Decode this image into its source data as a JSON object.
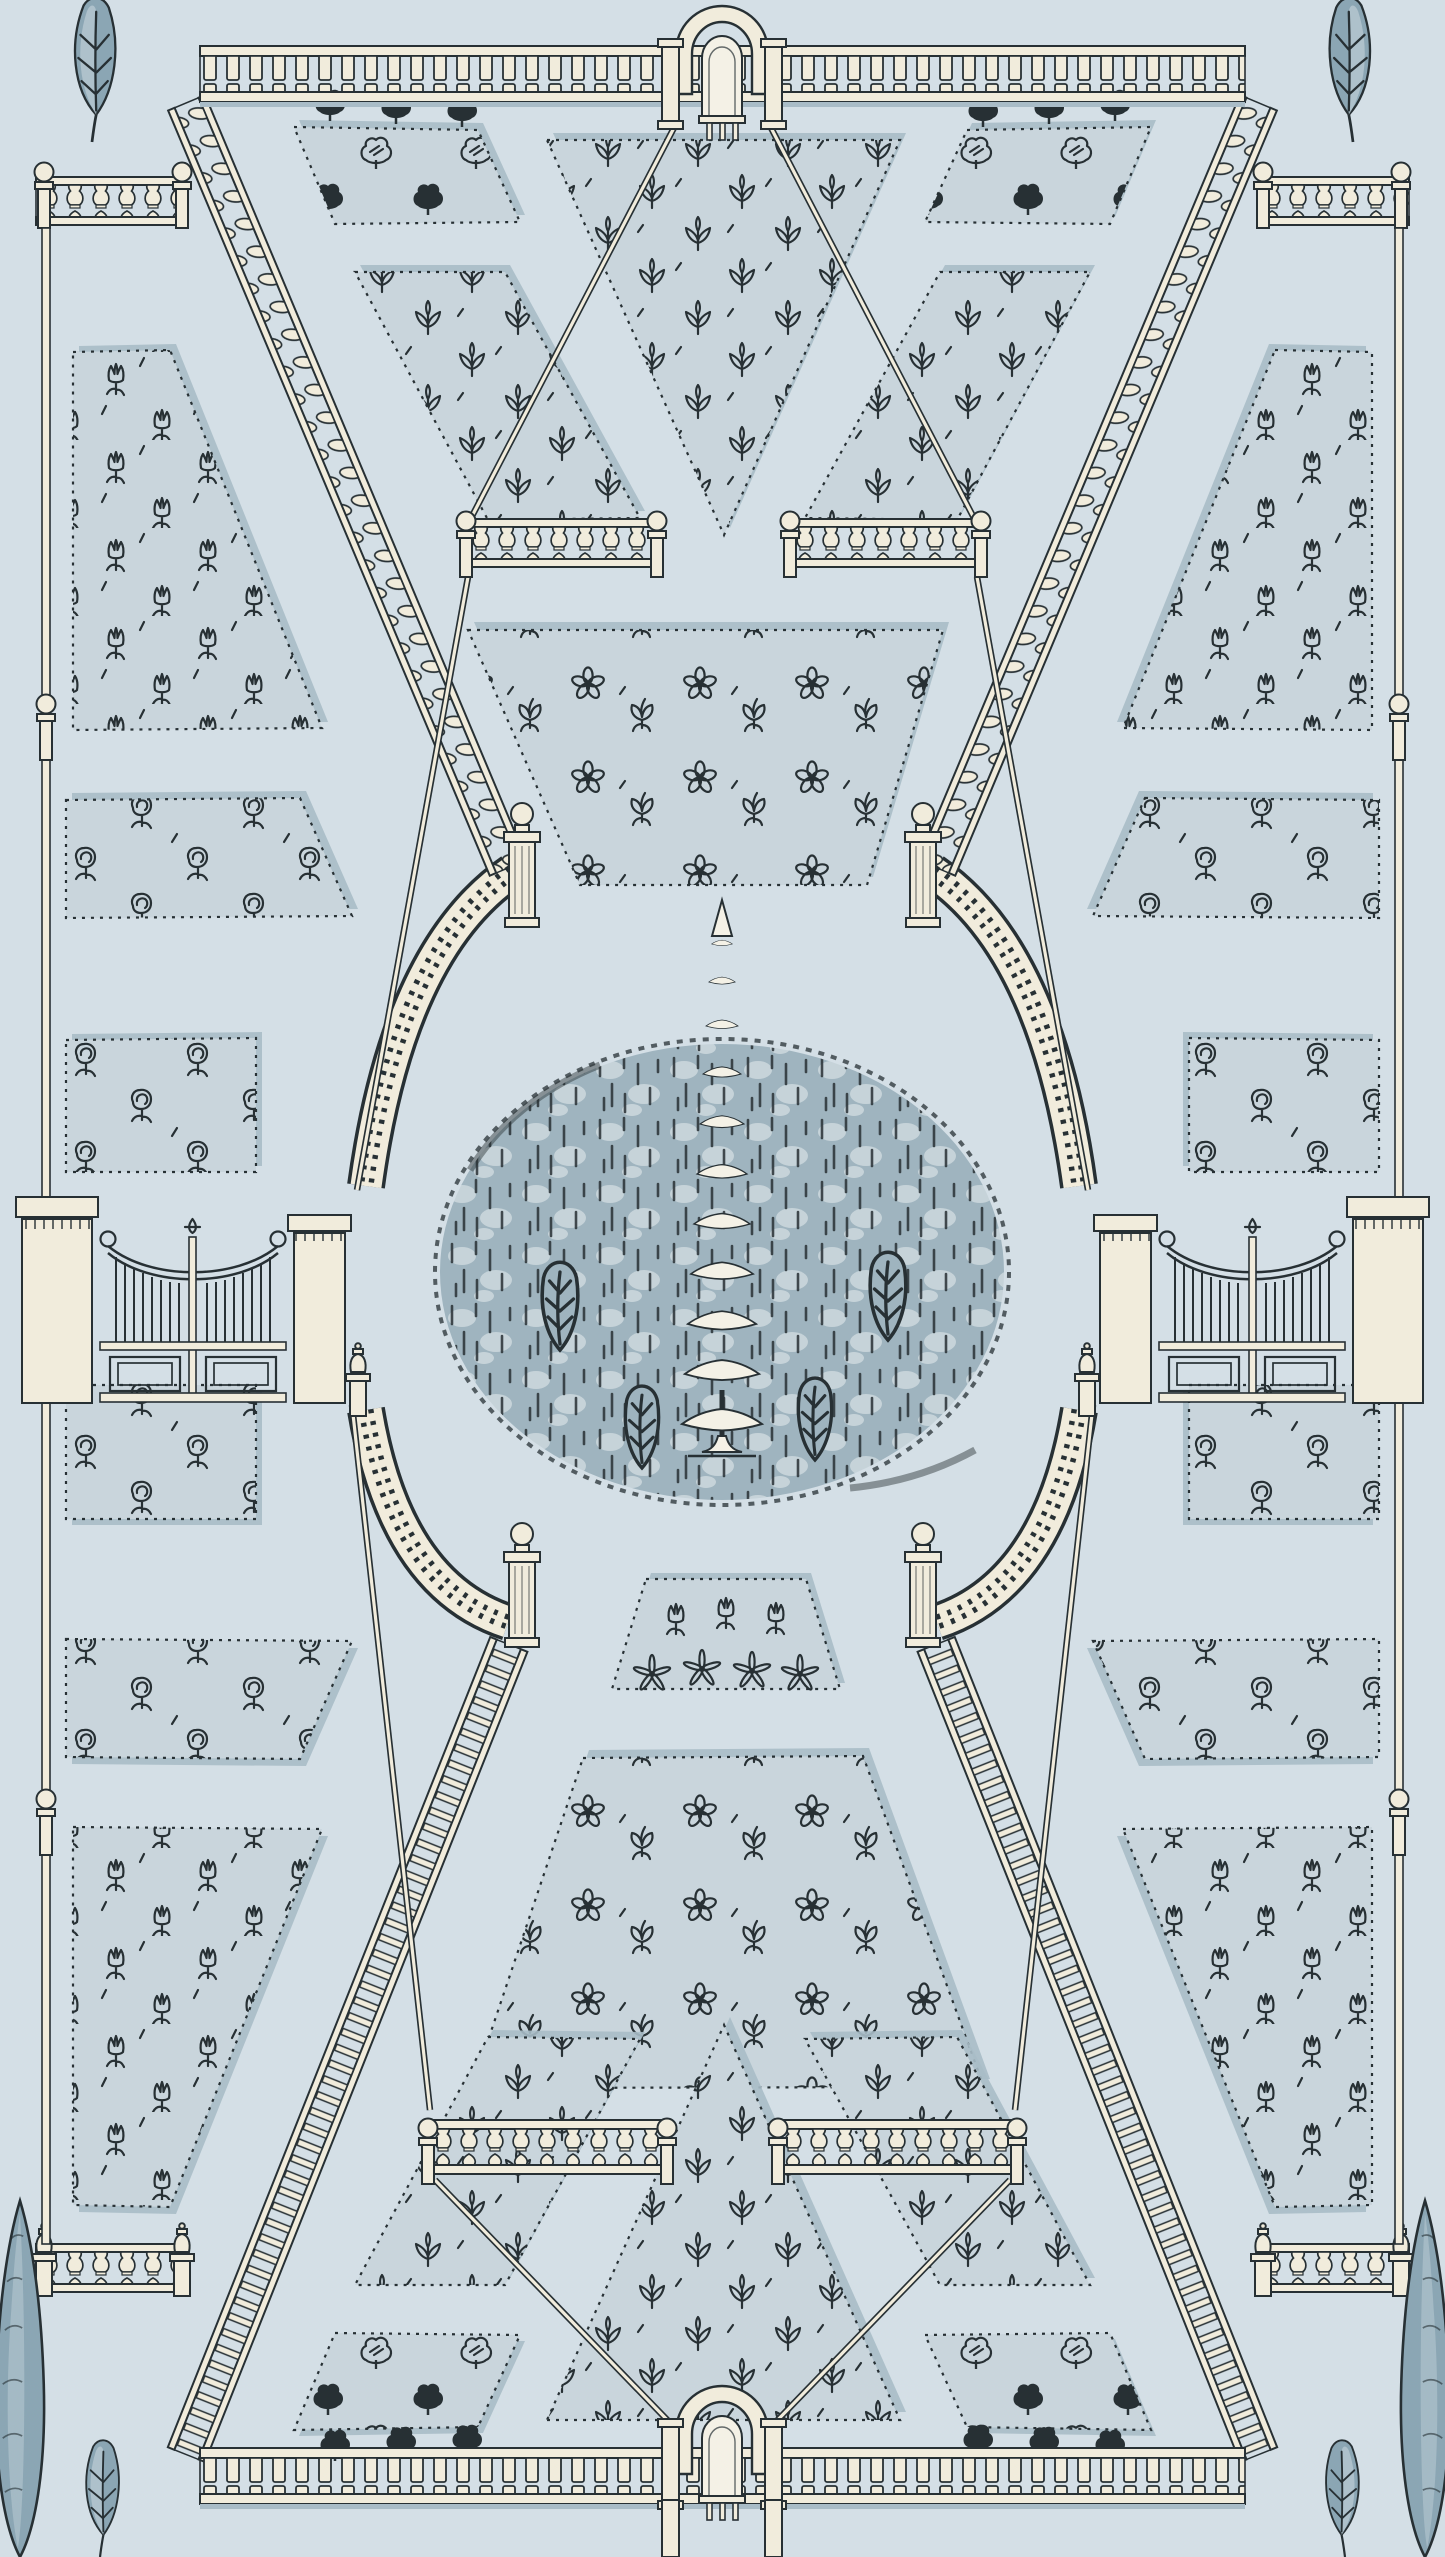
{
  "scene": {
    "kind": "decorative wallpaper pattern",
    "subject": "formal parterre garden plan in toile engraving style",
    "text_content": "none"
  },
  "palette": {
    "bg": "#d4dfe6",
    "bed": "#c9d5dc",
    "bed-shadow": "#a9bcc7",
    "ink": "#273034",
    "cream": "#f1ecdc",
    "cream-dark": "#b9b2a0",
    "stone": "#ddd7c6",
    "paper": "#f4f1e6",
    "oval": "#9fb4bf",
    "oval-dapple": "#c6d3d9",
    "foliage": "#8ba6b4",
    "foliage-light": "#b9cad3"
  },
  "motifs": {
    "sprig": "small sprout with two leaves and bud",
    "bloom": "five-petal blossom",
    "clover": "clover leaf spray",
    "tulip": "tulip bloom on stem",
    "rose": "round rose bloom with swirl",
    "star": "narrow-petal star flower",
    "bush": "round topiary bush",
    "plume": "feather shrub",
    "cypress": "tall cypress tree",
    "leaf": "feather leaf branch",
    "conifer": "central tiered conifer tree"
  },
  "elements": {
    "paling_fences": 2,
    "gateway_arches": 2,
    "double_gates": 2,
    "balustrade_arcs": 4,
    "twisted_diagonal_balustrades": 2,
    "rung_diagonal_balustrades": 2,
    "thin_walkway_rails": 8,
    "short_balustrades": 8,
    "ball_finial_posts": 18,
    "urn_finial_posts": 6,
    "fluted_piers": 4,
    "flower_beds": 22,
    "central_oval": {
      "tree": "conifer",
      "shrubs": 4
    },
    "edge_flora": {
      "top_leaves": 2,
      "bottom_cypresses": 2,
      "bottom_saplings": 2
    }
  }
}
